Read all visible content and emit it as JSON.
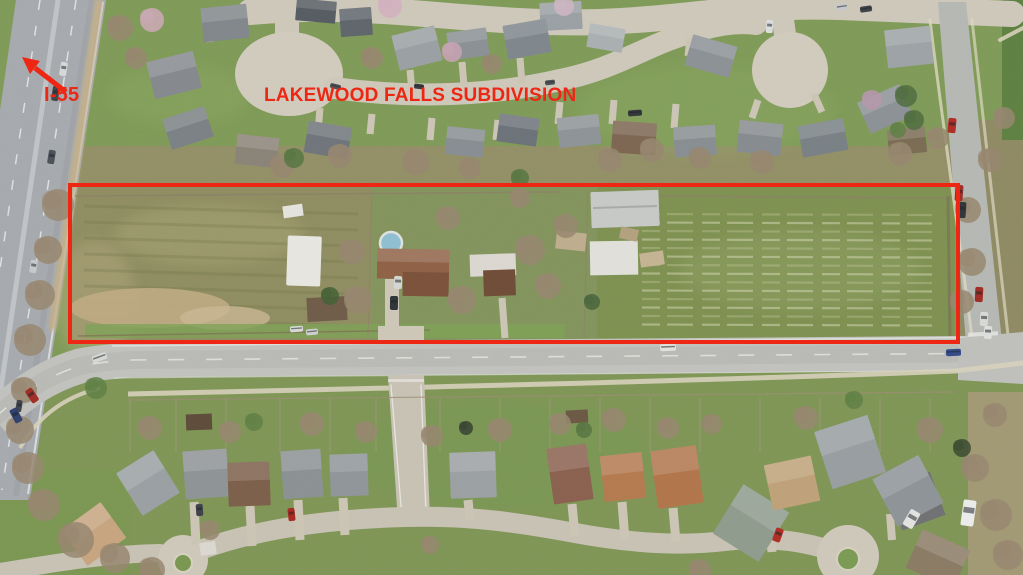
{
  "annotations": {
    "highway_label": "I-55",
    "subdivision_label": "LAKEWOOD FALLS SUBDIVISION",
    "annotation_color": "#ee2715",
    "parcel_outline_shape": "rectangle"
  },
  "scene": {
    "type": "aerial-photograph",
    "highway": "I-55",
    "subdivision": "LAKEWOOD FALLS SUBDIVISION",
    "outlined_area": "long rectangular land parcel with homes, sheds and tilled field between subdivision and arterial road",
    "palette": {
      "grass": "#7f9b57",
      "scrub_field": "#8f8d60",
      "tilled_field": "#7e9150",
      "asphalt_road": "#c2c3bf",
      "highway": "#a7abaf",
      "concrete_street": "#cfc9bb",
      "roof_gray": "#8f9598",
      "roof_terracotta": "#b5794e",
      "roof_tan": "#c7a57f"
    }
  }
}
